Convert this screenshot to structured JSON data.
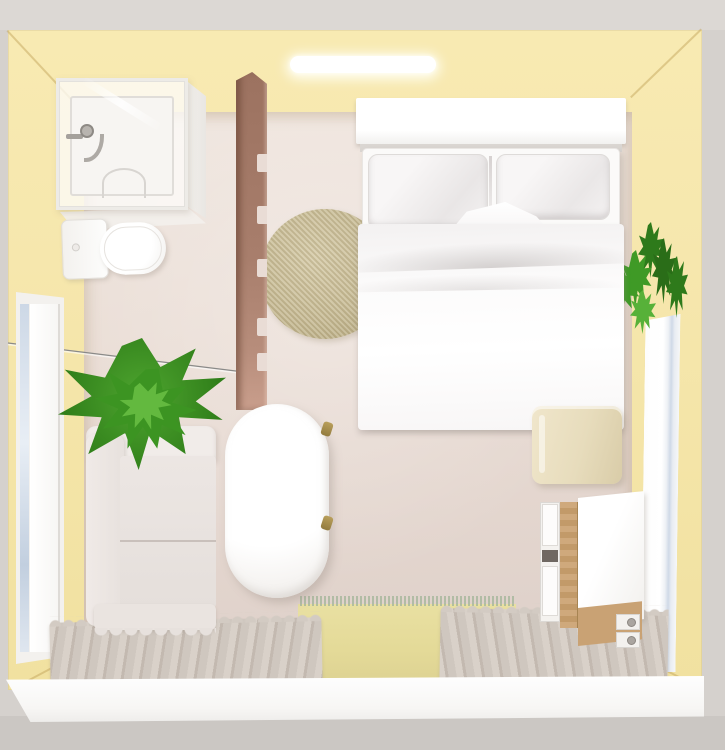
{
  "scene": {
    "view": "top-down 3d interior render",
    "room_type": "studio bedroom with open bathroom corner",
    "items": [
      {
        "id": "ceiling-light-bar",
        "label": "recessed ceiling light bar"
      },
      {
        "id": "shower-cabin",
        "label": "glass corner shower with tray and faucet"
      },
      {
        "id": "toilet",
        "label": "toilet with tank"
      },
      {
        "id": "wood-slat-partition",
        "label": "wooden slat partition"
      },
      {
        "id": "wall-wire",
        "label": "thin wall-mounted rail wire"
      },
      {
        "id": "round-jute-rug",
        "label": "round woven jute rug"
      },
      {
        "id": "double-bed",
        "label": "double bed with white headboard, two pillows and duvet"
      },
      {
        "id": "nightstand",
        "label": "beige bedside cabinet"
      },
      {
        "id": "left-window",
        "label": "tall window in left wall"
      },
      {
        "id": "right-window-planter",
        "label": "tall right-wall window with trailing plant"
      },
      {
        "id": "sofa",
        "label": "white sofa against left wall"
      },
      {
        "id": "potted-plant",
        "label": "potted green plant on sofa arm"
      },
      {
        "id": "bathtub",
        "label": "freestanding oval bathtub with brass taps"
      },
      {
        "id": "desk",
        "label": "desk with wood side panel, drawer unit and castor knobs"
      },
      {
        "id": "left-runner-rug",
        "label": "striped runner rug"
      },
      {
        "id": "center-mat",
        "label": "pale yellow mat with fringe"
      },
      {
        "id": "right-runner-rug",
        "label": "striped runner rug"
      }
    ]
  },
  "colors": {
    "backdrop_top": "#dcd8d4",
    "backdrop_side": "#d5d1cd",
    "backdrop_bottom": "#cbc7c3",
    "wall_yellow": "#f6e7ad",
    "floor_light": "#efe5de",
    "floor_dark": "#ddcfc8",
    "front_wall_white": "#fefefe",
    "wood_partition": "#a87e6c",
    "rug_round": "#c9bd97",
    "rug_round_dark": "#b7aa81",
    "nightstand": "#e7dcbc",
    "sofa": "#ece6e3",
    "brass": "#927b3e",
    "plant_green": "#4ea52f",
    "plant_green_dark": "#2e7a1b",
    "desk_wood": "#c29a69",
    "window_glass": "#cdd8e6",
    "runner_rug": "#d9d1c9",
    "runner_stripe": "#c3b9b0",
    "mat_yellow": "#e9e0a2",
    "mat_fringe": "#a9b89e",
    "light_bar": "#ffffff",
    "wire_gray": "#8a8a88"
  }
}
